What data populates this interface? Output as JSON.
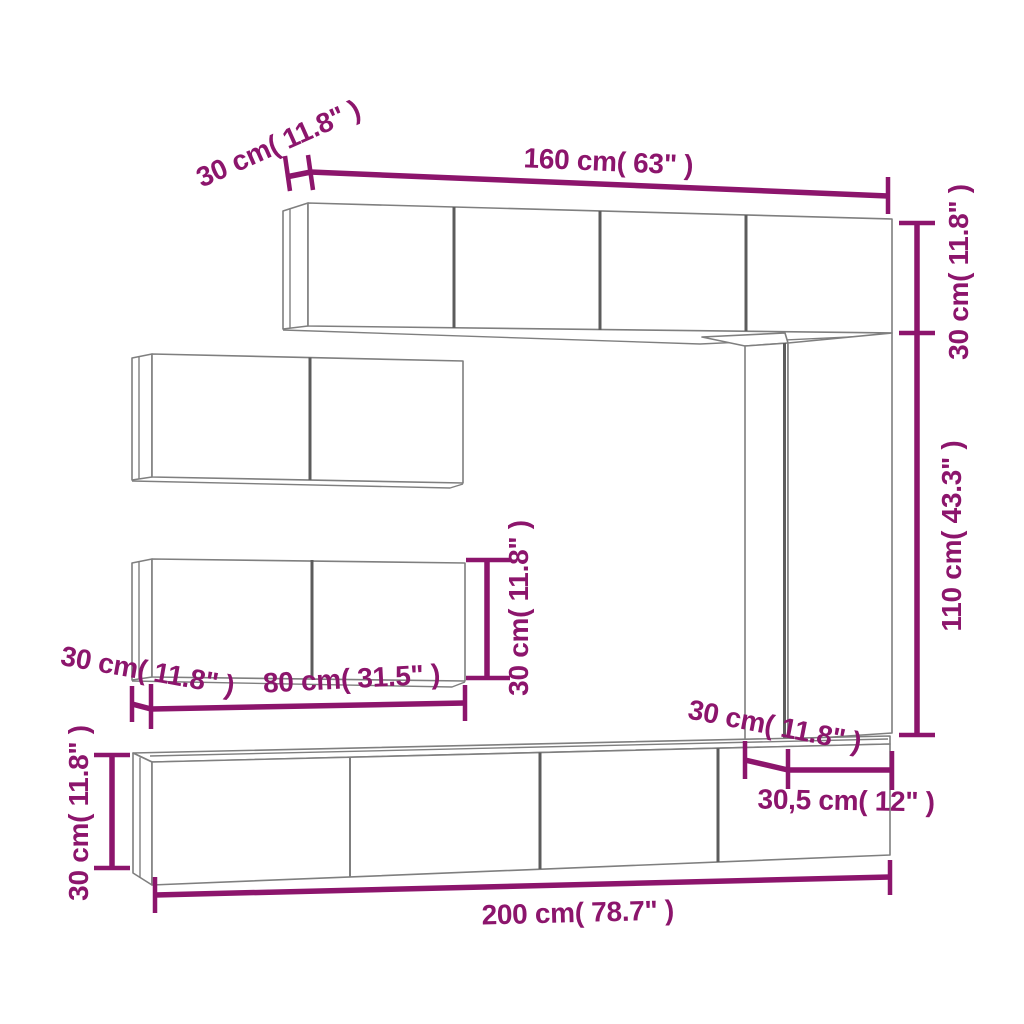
{
  "diagram_title": "TV wall cabinet set dimension diagram",
  "labels": {
    "top_depth": "30 cm( 11.8\" )",
    "top_width": "160 cm( 63\" )",
    "right_upper_height": "30 cm( 11.8\" )",
    "right_lower_height": "110 cm( 43.3\" )",
    "mid_cabinet_height": "30 cm( 11.8\" )",
    "mid_cabinet_depth": "30 cm( 11.8\" )",
    "mid_cabinet_width": "80 cm( 31.5\" )",
    "column_depth": "30 cm( 11.8\" )",
    "column_width": "30,5 cm( 12\" )",
    "bottom_cabinet_height": "30 cm( 11.8\" )",
    "bottom_cabinet_width": "200 cm( 78.7\" )"
  },
  "colors": {
    "dimension": "#8c156c",
    "outline": "#7f7f7f",
    "division": "#5c5c5c",
    "background": "#ffffff"
  }
}
